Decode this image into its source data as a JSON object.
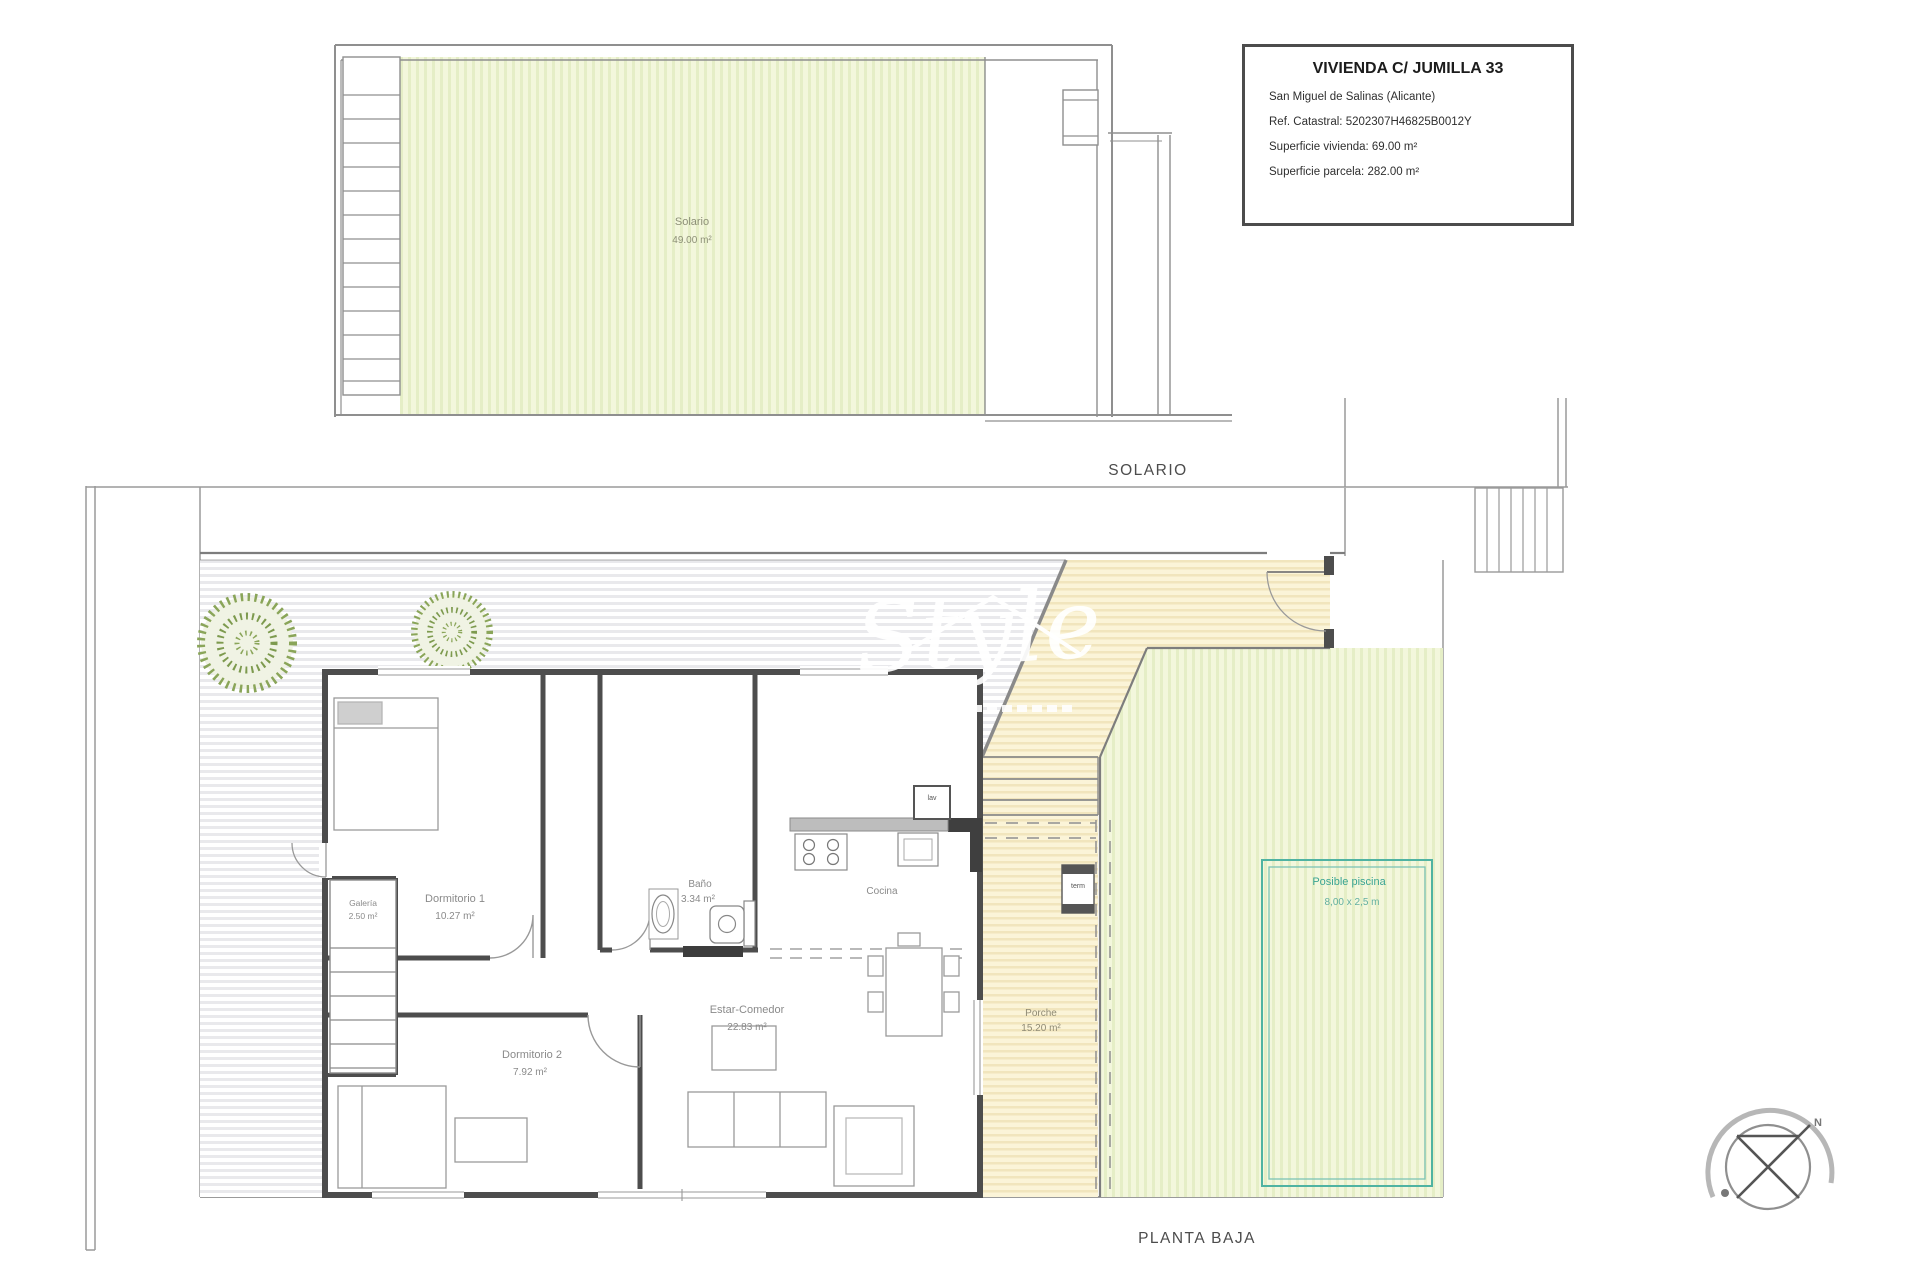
{
  "title_block": {
    "title": "VIVIENDA C/ JUMILLA 33",
    "location": "San Miguel de Salinas (Alicante)",
    "cadastral": "Ref. Catastral: 5202307H46825B0012Y",
    "area_dwelling": "Superficie vivienda: 69.00 m²",
    "area_plot": "Superficie parcela: 282.00 m²"
  },
  "captions": {
    "solario": "SOLARIO",
    "planta_baja": "PLANTA BAJA"
  },
  "solarium_plan": {
    "room_name": "Solario",
    "room_area": "49.00 m²"
  },
  "ground_floor": {
    "dormitorio1_name": "Dormitorio 1",
    "dormitorio1_area": "10.27 m²",
    "dormitorio2_name": "Dormitorio 2",
    "dormitorio2_area": "7.92 m²",
    "bano_name": "Baño",
    "bano_area": "3.34 m²",
    "cocina_name": "Cocina",
    "estar_name": "Estar-Comedor",
    "estar_area": "22.83 m²",
    "porche_name": "Porche",
    "porche_area": "15.20 m²",
    "galeria_name": "Galería",
    "galeria_area": "2.50 m²",
    "pool_name": "Posible piscina",
    "pool_dims": "8,00 x 2,5 m",
    "laundry_box": "lav",
    "heater_box": "term"
  },
  "compass": {
    "north": "N"
  },
  "watermark": {
    "text": "Style"
  },
  "colors": {
    "wall_dark": "#4d4d4d",
    "line_gray": "#9a9a9a",
    "garden_fill": "#f3f7dc",
    "porch_fill": "#fbf4d8",
    "pool_accent": "#3aa493"
  }
}
